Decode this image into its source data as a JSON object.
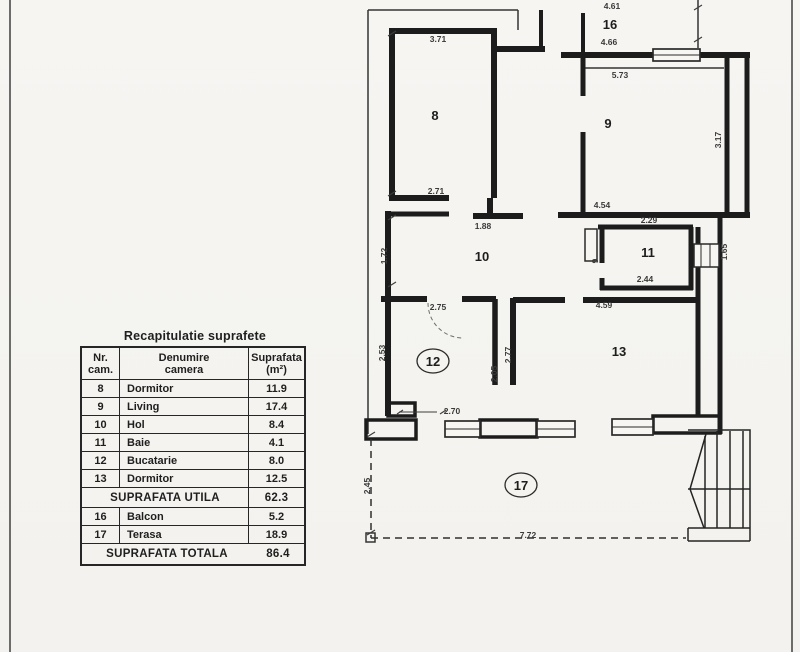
{
  "table": {
    "title": "Recapitulatie suprafete",
    "headers": {
      "col1a": "Nr.",
      "col1b": "cam.",
      "col2a": "Denumire",
      "col2b": "camera",
      "col3a": "Suprafata",
      "col3b": "(m²)"
    },
    "rows": [
      {
        "nr": "8",
        "name": "Dormitor",
        "area": "11.9"
      },
      {
        "nr": "9",
        "name": "Living",
        "area": "17.4"
      },
      {
        "nr": "10",
        "name": "Hol",
        "area": "8.4"
      },
      {
        "nr": "11",
        "name": "Baie",
        "area": "4.1"
      },
      {
        "nr": "12",
        "name": "Bucatarie",
        "area": "8.0"
      },
      {
        "nr": "13",
        "name": "Dormitor",
        "area": "12.5"
      }
    ],
    "subtotal": {
      "label": "SUPRAFATA UTILA",
      "value": "62.3"
    },
    "extra_rows": [
      {
        "nr": "16",
        "name": "Balcon",
        "area": "5.2"
      },
      {
        "nr": "17",
        "name": "Terasa",
        "area": "18.9"
      }
    ],
    "total": {
      "label": "SUPRAFATA TOTALA",
      "value": "86.4"
    }
  },
  "plan": {
    "ink": "#1c1c1c",
    "paper": "#f5f4f1",
    "rooms": [
      {
        "number": "8"
      },
      {
        "number": "9"
      },
      {
        "number": "10"
      },
      {
        "number": "11"
      },
      {
        "number": "12"
      },
      {
        "number": "13"
      },
      {
        "number": "16"
      },
      {
        "number": "17"
      }
    ],
    "dims": [
      {
        "text": "4.61"
      },
      {
        "text": "4.66"
      },
      {
        "text": "5.73"
      },
      {
        "text": "3.71"
      },
      {
        "text": "2.71"
      },
      {
        "text": "1.88"
      },
      {
        "text": "4.54"
      },
      {
        "text": "2.29"
      },
      {
        "text": "2.44"
      },
      {
        "text": "2.75"
      },
      {
        "text": "4.59"
      },
      {
        "text": "2.70"
      },
      {
        "text": "7.72"
      },
      {
        "text": "1.72"
      },
      {
        "text": "2.53"
      },
      {
        "text": "2.05"
      },
      {
        "text": "2.77"
      },
      {
        "text": "3.17"
      },
      {
        "text": "1.65"
      },
      {
        "text": "9"
      },
      {
        "text": "2.45"
      }
    ]
  }
}
